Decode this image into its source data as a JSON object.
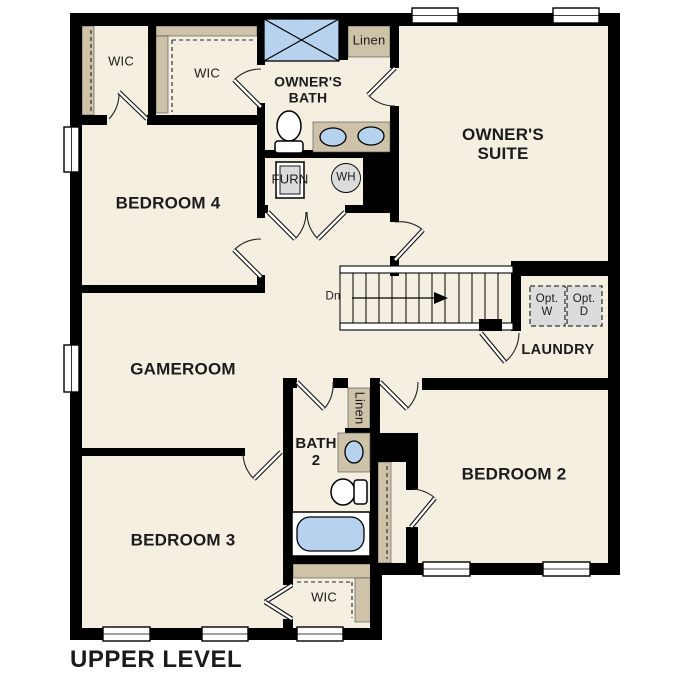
{
  "title": "UPPER LEVEL",
  "rooms": {
    "owners_suite": "OWNER'S\nSUITE",
    "owners_bath": "OWNER'S\nBATH",
    "bedroom2": "BEDROOM 2",
    "bedroom3": "BEDROOM 3",
    "bedroom4": "BEDROOM 4",
    "gameroom": "GAMEROOM",
    "bath2": "BATH\n2",
    "laundry": "LAUNDRY",
    "wic_bedroom4": "WIC",
    "wic_owners": "WIC",
    "wic_bedroom3": "WIC"
  },
  "closets": {
    "linen_upper": "Linen",
    "linen_bath2": "Linen"
  },
  "fixtures": {
    "furnace": "FURN",
    "water_heater": "WH",
    "opt_washer": "Opt.\nW",
    "opt_dryer": "Opt.\nD"
  },
  "stairs": {
    "down_label": "Dn"
  },
  "theme": {
    "room_fill": "#f5efe2",
    "closet_tan": "#cec2a8",
    "fixture_blue": "#b7d2ee",
    "fixture_gray": "#dcdcdc",
    "wall": "#000000",
    "page_bg": "#ffffff"
  }
}
